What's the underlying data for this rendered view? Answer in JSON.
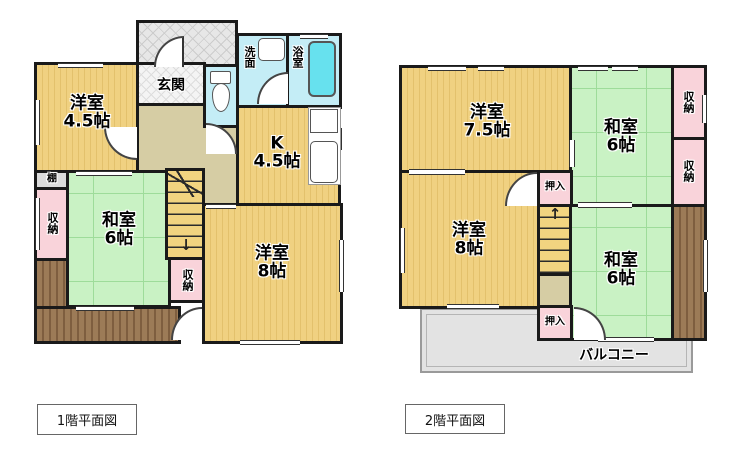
{
  "document": {
    "type": "floorplan",
    "colors": {
      "wall": "#1a1a1a",
      "western_room_yellow": "#f0d181",
      "japanese_room_green": "#c9f2c4",
      "closet_pink": "#f9d3da",
      "water_area_blue": "#c4edf6",
      "bathtub_cyan": "#67e1ee",
      "hall_tan": "#d6cda4",
      "veranda_brown": "#9c7b57",
      "porch_gray": "#e7e7e7",
      "balcony_gray": "#e3e3e3"
    }
  },
  "floor1": {
    "caption": "1階平面図",
    "rooms": {
      "western45": {
        "name": "洋室",
        "size": "4.5帖"
      },
      "entrance": {
        "label": "玄関"
      },
      "washstand": {
        "label": "洗面"
      },
      "bathroom": {
        "label": "浴室"
      },
      "kitchen": {
        "name": "K",
        "size": "4.5帖"
      },
      "japanese6": {
        "name": "和室",
        "size": "6帖"
      },
      "western8": {
        "name": "洋室",
        "size": "8帖"
      },
      "shelf": {
        "label": "棚"
      },
      "closet_west": {
        "label": "収納"
      },
      "closet_stairs": {
        "label": "収納"
      }
    },
    "stairs": {
      "direction_arrow": "↓"
    }
  },
  "floor2": {
    "caption": "2階平面図",
    "rooms": {
      "western75": {
        "name": "洋室",
        "size": "7.5帖"
      },
      "japanese6_north": {
        "name": "和室",
        "size": "6帖"
      },
      "japanese6_south": {
        "name": "和室",
        "size": "6帖"
      },
      "western8": {
        "name": "洋室",
        "size": "8帖"
      },
      "closet_north": {
        "label": "収納"
      },
      "closet_mid": {
        "label": "収納"
      },
      "oshiire_north": {
        "label": "押入"
      },
      "oshiire_south": {
        "label": "押入"
      },
      "balcony": {
        "label": "バルコニー"
      }
    },
    "stairs": {
      "direction_arrow": "↑"
    }
  }
}
